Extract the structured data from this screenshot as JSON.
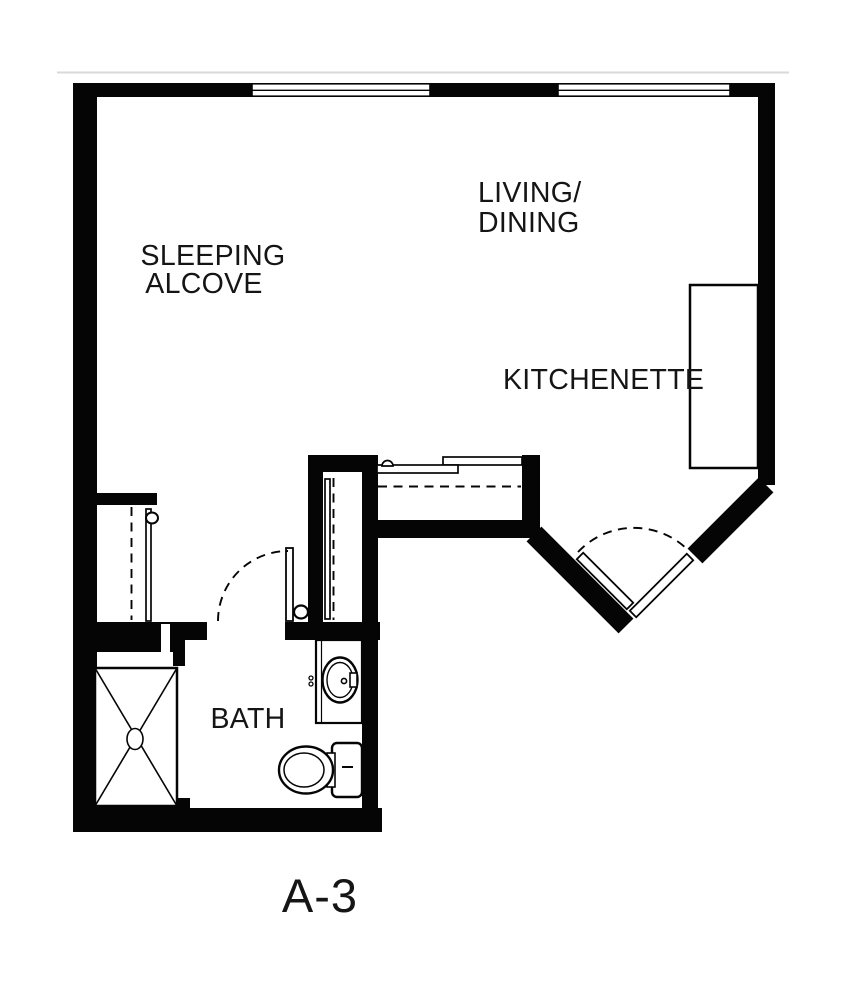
{
  "floor_plan": {
    "unit_label": "A-3",
    "rooms": {
      "sleeping_alcove": {
        "label_line1": "SLEEPING",
        "label_line2": "ALCOVE"
      },
      "living_dining": {
        "label_line1": "LIVING/",
        "label_line2": "DINING"
      },
      "kitchenette": {
        "label": "KITCHENETTE"
      },
      "bath": {
        "label": "BATH"
      }
    },
    "fixtures": [
      "window",
      "window",
      "entry-door",
      "bath-door",
      "left-closet-door",
      "middle-closet-door",
      "sliding-closet-doors",
      "kitchenette-counter",
      "shower-pan",
      "vanity-sink",
      "toilet"
    ],
    "colors": {
      "walls": "#050505",
      "labels": "#151515",
      "background": "#ffffff",
      "scan_line": "#d9d9d9"
    }
  }
}
